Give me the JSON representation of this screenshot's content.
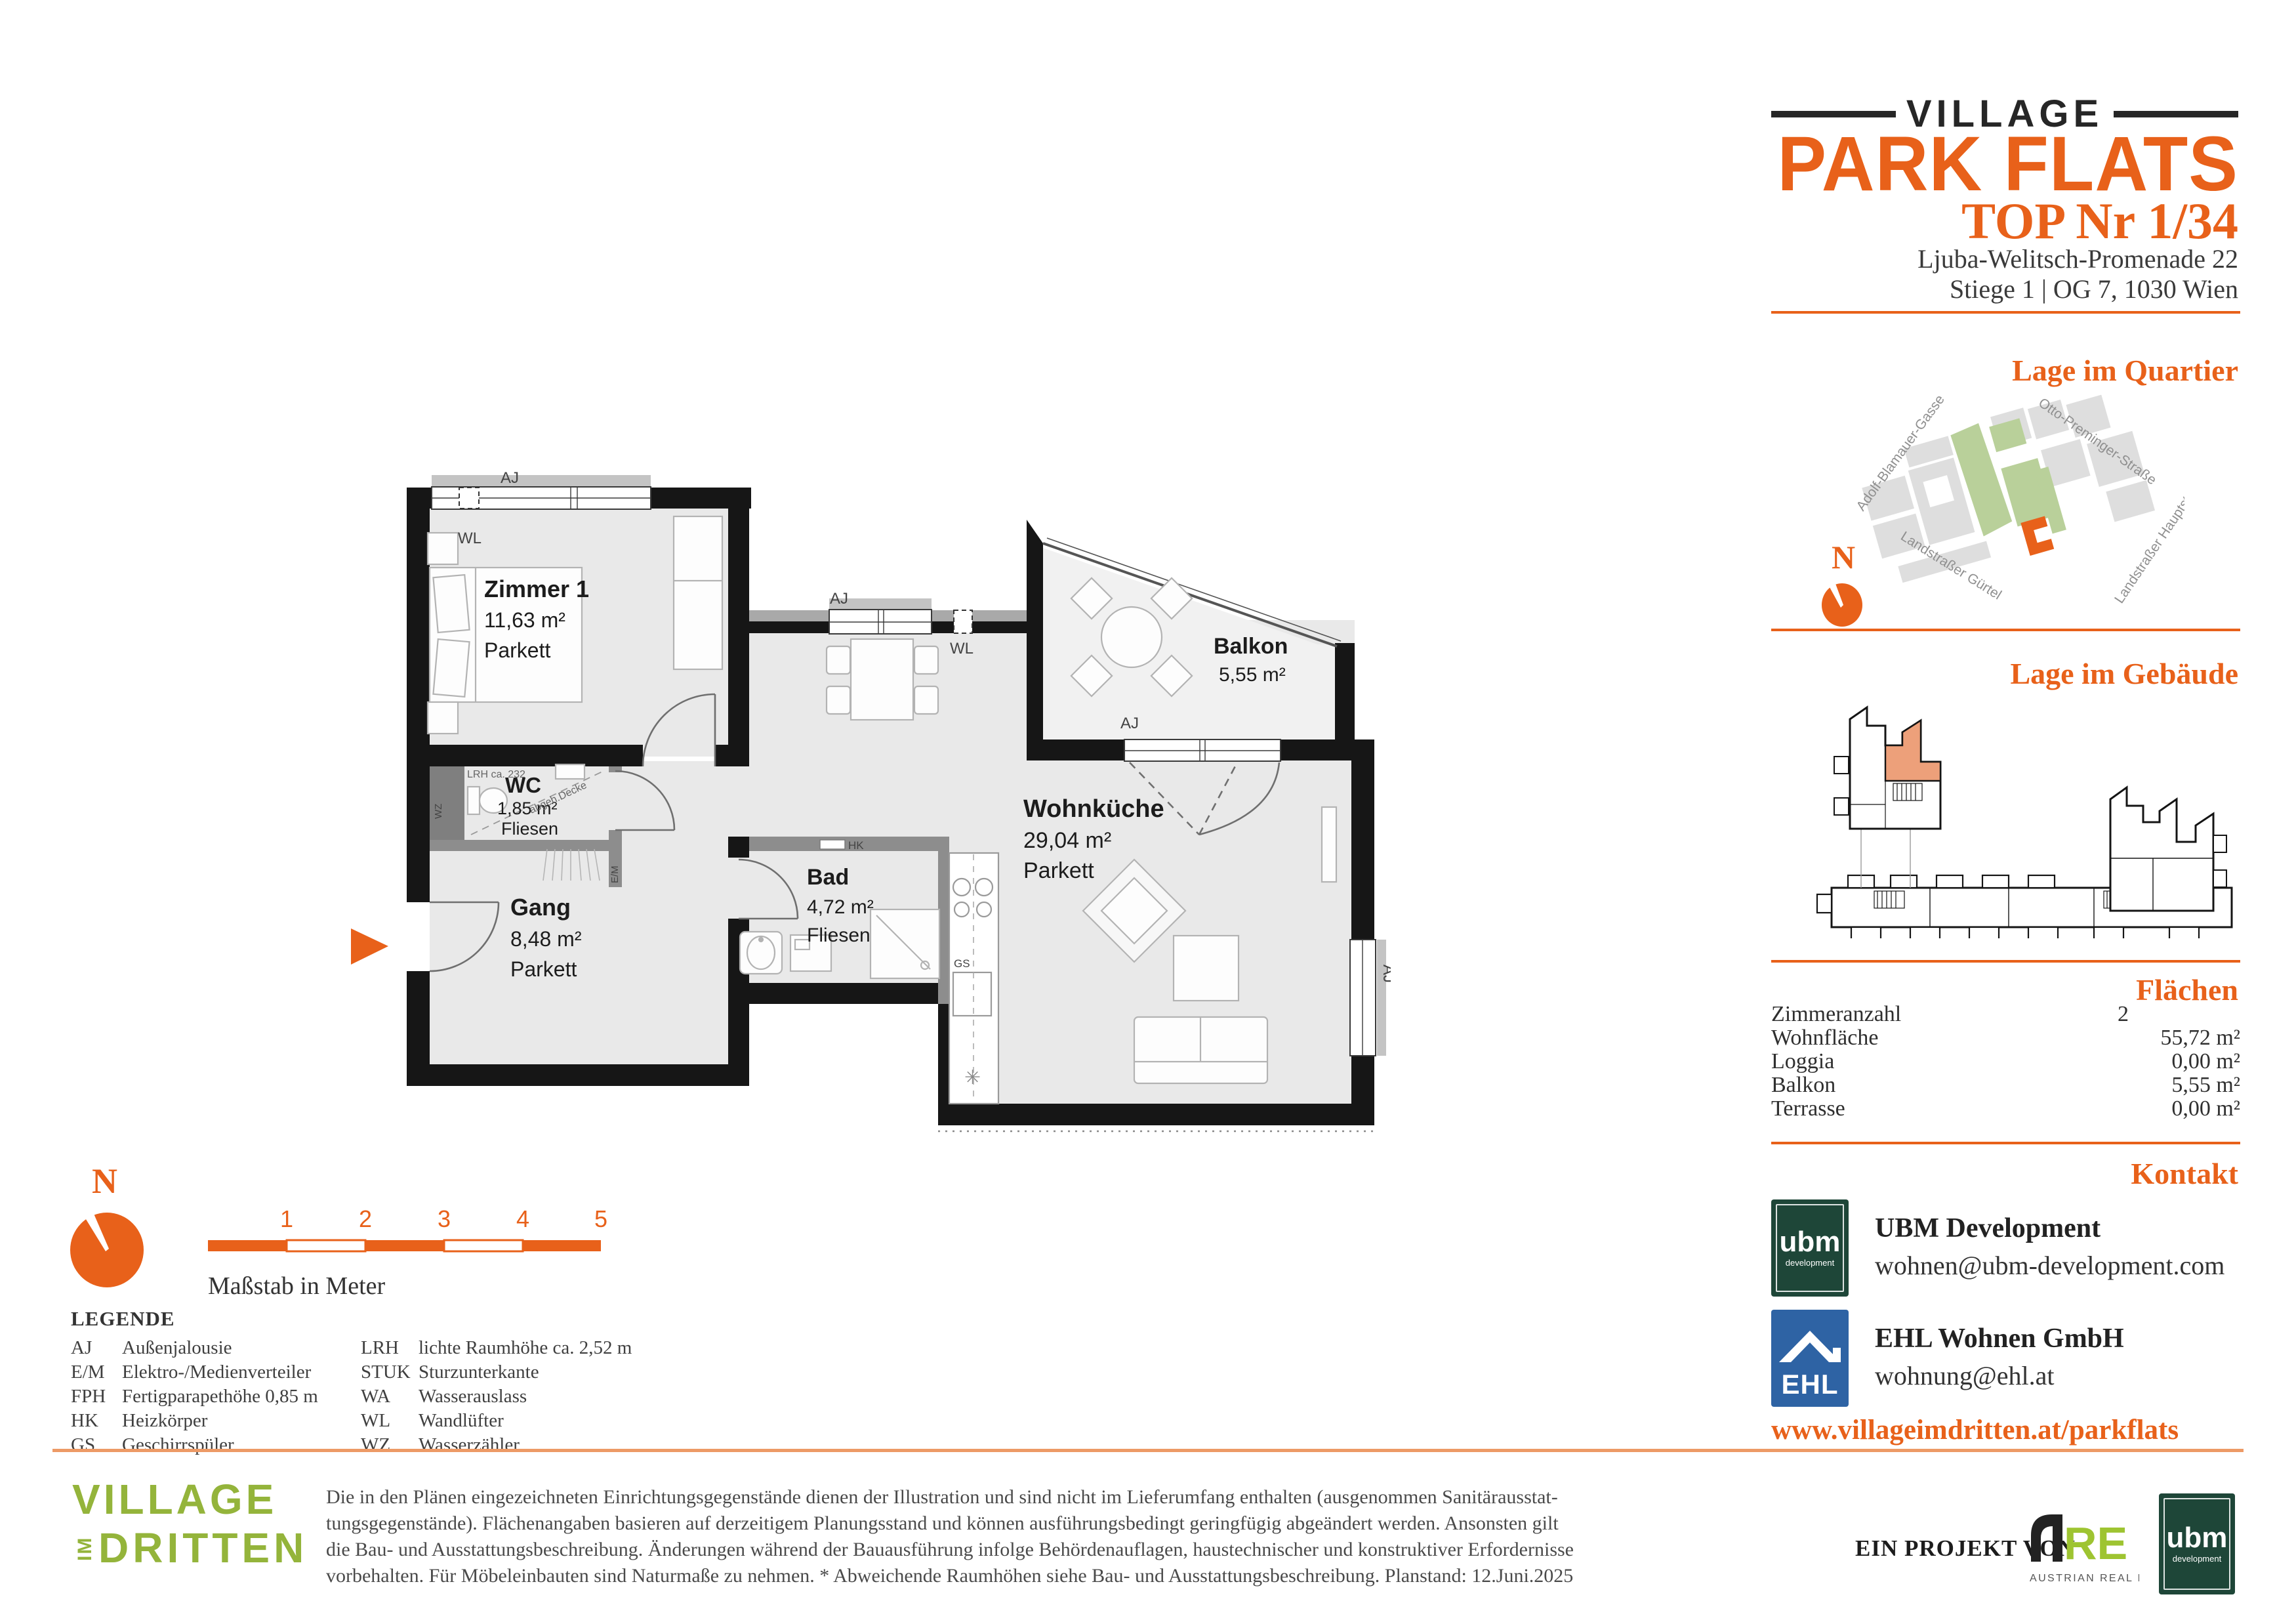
{
  "colors": {
    "accent": "#E8611A",
    "unit_highlight": "#EDA07A",
    "village_green": "#94B43B",
    "ubm_green": "#1E4638",
    "ehl_blue": "#2E63A4",
    "are_green": "#9EC431",
    "map_green": "#B9D09A"
  },
  "header": {
    "brand_top": "VILLAGE",
    "brand_main": "PARK FLATS",
    "unit_title": "TOP Nr 1/34",
    "address_line1": "Ljuba-Welitsch-Promenade 22",
    "address_line2": "Stiege 1 | OG 7, 1030 Wien"
  },
  "sections": {
    "quartier_title": "Lage im Quartier",
    "gebaeude_title": "Lage im Gebäude",
    "flaechen_title": "Flächen",
    "kontakt_title": "Kontakt"
  },
  "map": {
    "north_label": "N",
    "streets": [
      "Adolf-Blamauer-Gasse",
      "Otto-Preminger-Straße",
      "Landstraßer Gürtel",
      "Landstraßer Hauptstraße"
    ]
  },
  "flaechen": {
    "rows": [
      {
        "label": "Zimmeranzahl",
        "value": "2"
      },
      {
        "label": "Wohnfläche",
        "value": "55,72 m²"
      },
      {
        "label": "Loggia",
        "value": "0,00 m²"
      },
      {
        "label": "Balkon",
        "value": "5,55 m²"
      },
      {
        "label": "Terrasse",
        "value": "0,00 m²"
      }
    ]
  },
  "kontakt": {
    "ubm_name": "UBM Development",
    "ubm_email": "wohnen@ubm-development.com",
    "ehl_name": "EHL Wohnen GmbH",
    "ehl_email": "wohnung@ehl.at",
    "website": "www.villageimdritten.at/parkflats",
    "ubm_logo_line1": "ubm",
    "ubm_logo_line2": "development",
    "ehl_logo_text": "EHL"
  },
  "floorplan": {
    "rooms": [
      {
        "name": "Zimmer 1",
        "area": "11,63 m²",
        "floor": "Parkett"
      },
      {
        "name": "WC",
        "area": "1,85 m²",
        "floor": "Fliesen"
      },
      {
        "name": "Gang",
        "area": "8,48 m²",
        "floor": "Parkett"
      },
      {
        "name": "Bad",
        "area": "4,72 m²",
        "floor": "Fliesen"
      },
      {
        "name": "Wohnküche",
        "area": "29,04 m²",
        "floor": "Parkett"
      },
      {
        "name": "Balkon",
        "area": "5,55 m²",
        "floor": ""
      }
    ],
    "labels": {
      "aj": "AJ",
      "wl": "WL",
      "hk": "HK",
      "gs": "GS",
      "em": "E/M",
      "wz": "WZ",
      "lrh": "LRH ca. 232",
      "ceiling": "abgeh.Decke"
    }
  },
  "scalebar": {
    "ticks": [
      "1",
      "2",
      "3",
      "4",
      "5"
    ],
    "caption": "Maßstab in Meter"
  },
  "compass": {
    "north_label": "N"
  },
  "legend": {
    "title": "LEGENDE",
    "col1": [
      {
        "abbr": "AJ",
        "text": "Außenjalousie"
      },
      {
        "abbr": "E/M",
        "text": "Elektro-/Medienverteiler"
      },
      {
        "abbr": "FPH",
        "text": "Fertigparapethöhe 0,85 m"
      },
      {
        "abbr": "HK",
        "text": "Heizkörper"
      },
      {
        "abbr": "GS",
        "text": "Geschirrspüler"
      }
    ],
    "col2": [
      {
        "abbr": "LRH",
        "text": "lichte Raumhöhe ca. 2,52 m"
      },
      {
        "abbr": "STUK",
        "text": "Sturzunterkante"
      },
      {
        "abbr": "WA",
        "text": "Wasserauslass"
      },
      {
        "abbr": "WL",
        "text": "Wandlüfter"
      },
      {
        "abbr": "WZ",
        "text": "Wasserzähler"
      }
    ]
  },
  "disclaimer": {
    "lines": [
      "Die in den Plänen eingezeichneten Einrichtungsgegenstände dienen der Illustration und sind nicht im Lieferumfang enthalten (ausgenommen Sanitärausstat-",
      "tungsgegenstände). Flächenangaben basieren auf derzeitigem Planungsstand und können ausführungsbedingt geringfügig abgeändert werden. Ansonsten gilt",
      "die Bau- und Ausstattungsbeschreibung. Änderungen während der Bauausführung infolge Behördenauflagen, haustechnischer und konstruktiver Erfordernisse",
      "vorbehalten. Für Möbeleinbauten sind Naturmaße zu nehmen. * Abweichende Raumhöhen siehe Bau- und Ausstattungsbeschreibung. Planstand: 12.Juni.2025"
    ]
  },
  "footer": {
    "village_line1": "VILLAGE",
    "village_im": "IM",
    "village_dritten": "DRITTEN",
    "project_label": "EIN PROJEKT VON",
    "are_re": "RE",
    "are_sub": "AUSTRIAN REAL ESTATE",
    "ubm_logo_line1": "ubm",
    "ubm_logo_line2": "development"
  }
}
